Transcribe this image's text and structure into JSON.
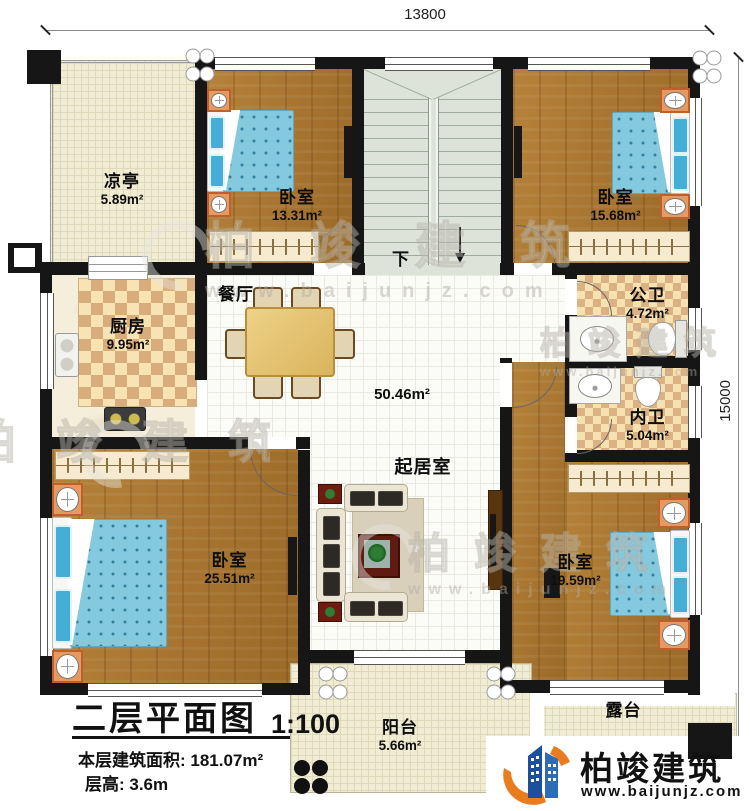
{
  "dimensions": {
    "top": "13800",
    "right": "15000"
  },
  "rooms": {
    "liangting": {
      "name": "凉亭",
      "area": "5.89m²"
    },
    "bedroom1": {
      "name": "卧室",
      "area": "13.31m²"
    },
    "bedroom2": {
      "name": "卧室",
      "area": "15.68m²"
    },
    "kitchen": {
      "name": "厨房",
      "area": "9.95m²"
    },
    "dining": {
      "name": "餐厅"
    },
    "living": {
      "name": "起居室",
      "area": "50.46m²"
    },
    "public_bath": {
      "name": "公卫",
      "area": "4.72m²"
    },
    "private_bath": {
      "name": "内卫",
      "area": "5.04m²"
    },
    "bedroom3": {
      "name": "卧室",
      "area": "25.51m²"
    },
    "bedroom4": {
      "name": "卧室",
      "area": "19.59m²"
    },
    "balcony": {
      "name": "阳台",
      "area": "5.66m²"
    },
    "terrace": {
      "name": "露台"
    }
  },
  "stairs": {
    "down_label": "下"
  },
  "title_block": {
    "name": "二层平面图",
    "scale": "1:100",
    "floor_area": "本层建筑面积: 181.07m²",
    "floor_height": "层高: 3.6m"
  },
  "brand": {
    "name": "柏竣建筑",
    "website": "www.baijunjz.com"
  },
  "watermark": {
    "text": "柏竣建筑",
    "website": "www.baijunjz.com"
  },
  "colors": {
    "wall": "#161616",
    "wood_floor": "#a8752f",
    "bed_fabric": "#84c9de",
    "checker_dark": "#d9ac7c",
    "checker_light": "#f8e4b2",
    "cream": "#f1edd5",
    "stairs": "#dde3d9",
    "logo_blue": "#1c4f9c",
    "logo_orange": "#e87c1e"
  }
}
